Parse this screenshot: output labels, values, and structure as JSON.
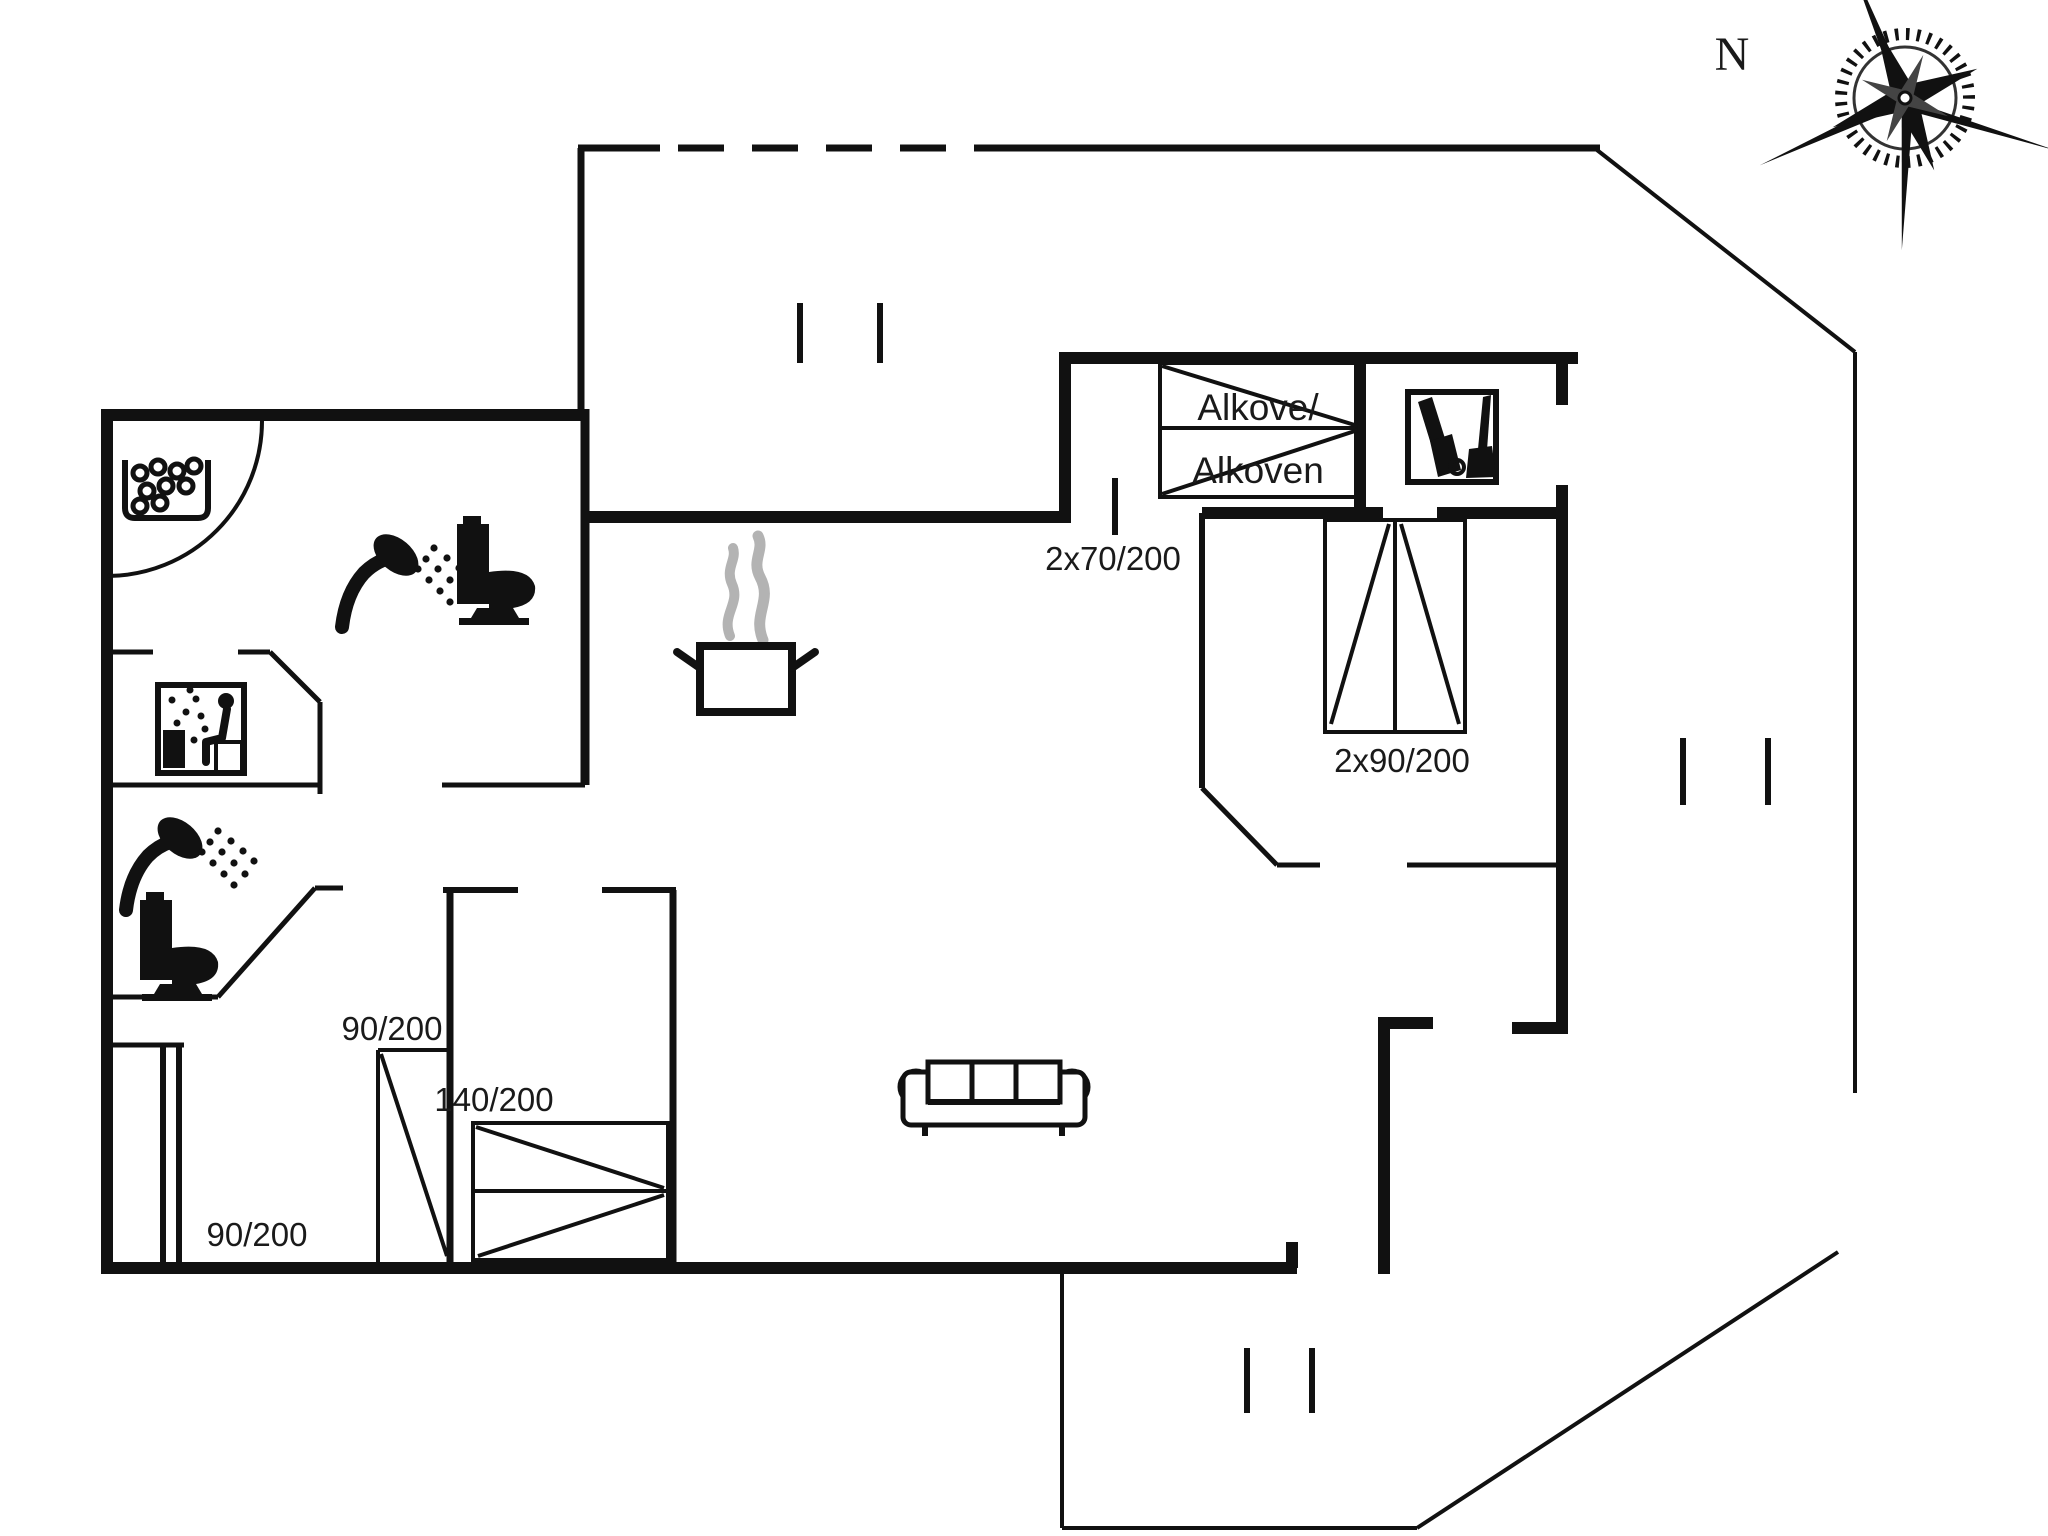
{
  "plan": {
    "type": "floor-plan",
    "language": "Danish",
    "compass": {
      "north_label": "N",
      "rose": "compass-rose pointing north-west toward label"
    },
    "rooms": {
      "alcove": {
        "label_line1": "Alkove/",
        "label_line2": "Alkoven",
        "bed_dimension": "2x70/200"
      },
      "bedroom_double": {
        "bed_dimension": "2x90/200"
      },
      "bedroom_single": {
        "bed_dimension": "90/200"
      },
      "bedroom_left": {
        "bed_dimension": "90/200",
        "second_bed_dimension": "140/200"
      }
    },
    "labels": {
      "north": "N",
      "alcove_line1": "Alkove/",
      "alcove_line2": "Alkoven",
      "dim_alcove": "2x70/200",
      "dim_double_bed": "2x90/200",
      "dim_single_bed_upper": "90/200",
      "dim_single_bed_lower": "90/200",
      "dim_wide_bed": "140/200"
    },
    "icons": [
      "compass-rose-icon",
      "whirlpool-icon",
      "shower-icon",
      "toilet-icon",
      "sauna-icon",
      "shower-icon",
      "toilet-icon",
      "cooking-pot-icon",
      "vacuum-cleaner-icon",
      "sofa-icon"
    ],
    "colors": {
      "walls": "#111111",
      "steam": "#b3b3b3",
      "background": "#ffffff",
      "text": "#1a1a1a"
    }
  }
}
